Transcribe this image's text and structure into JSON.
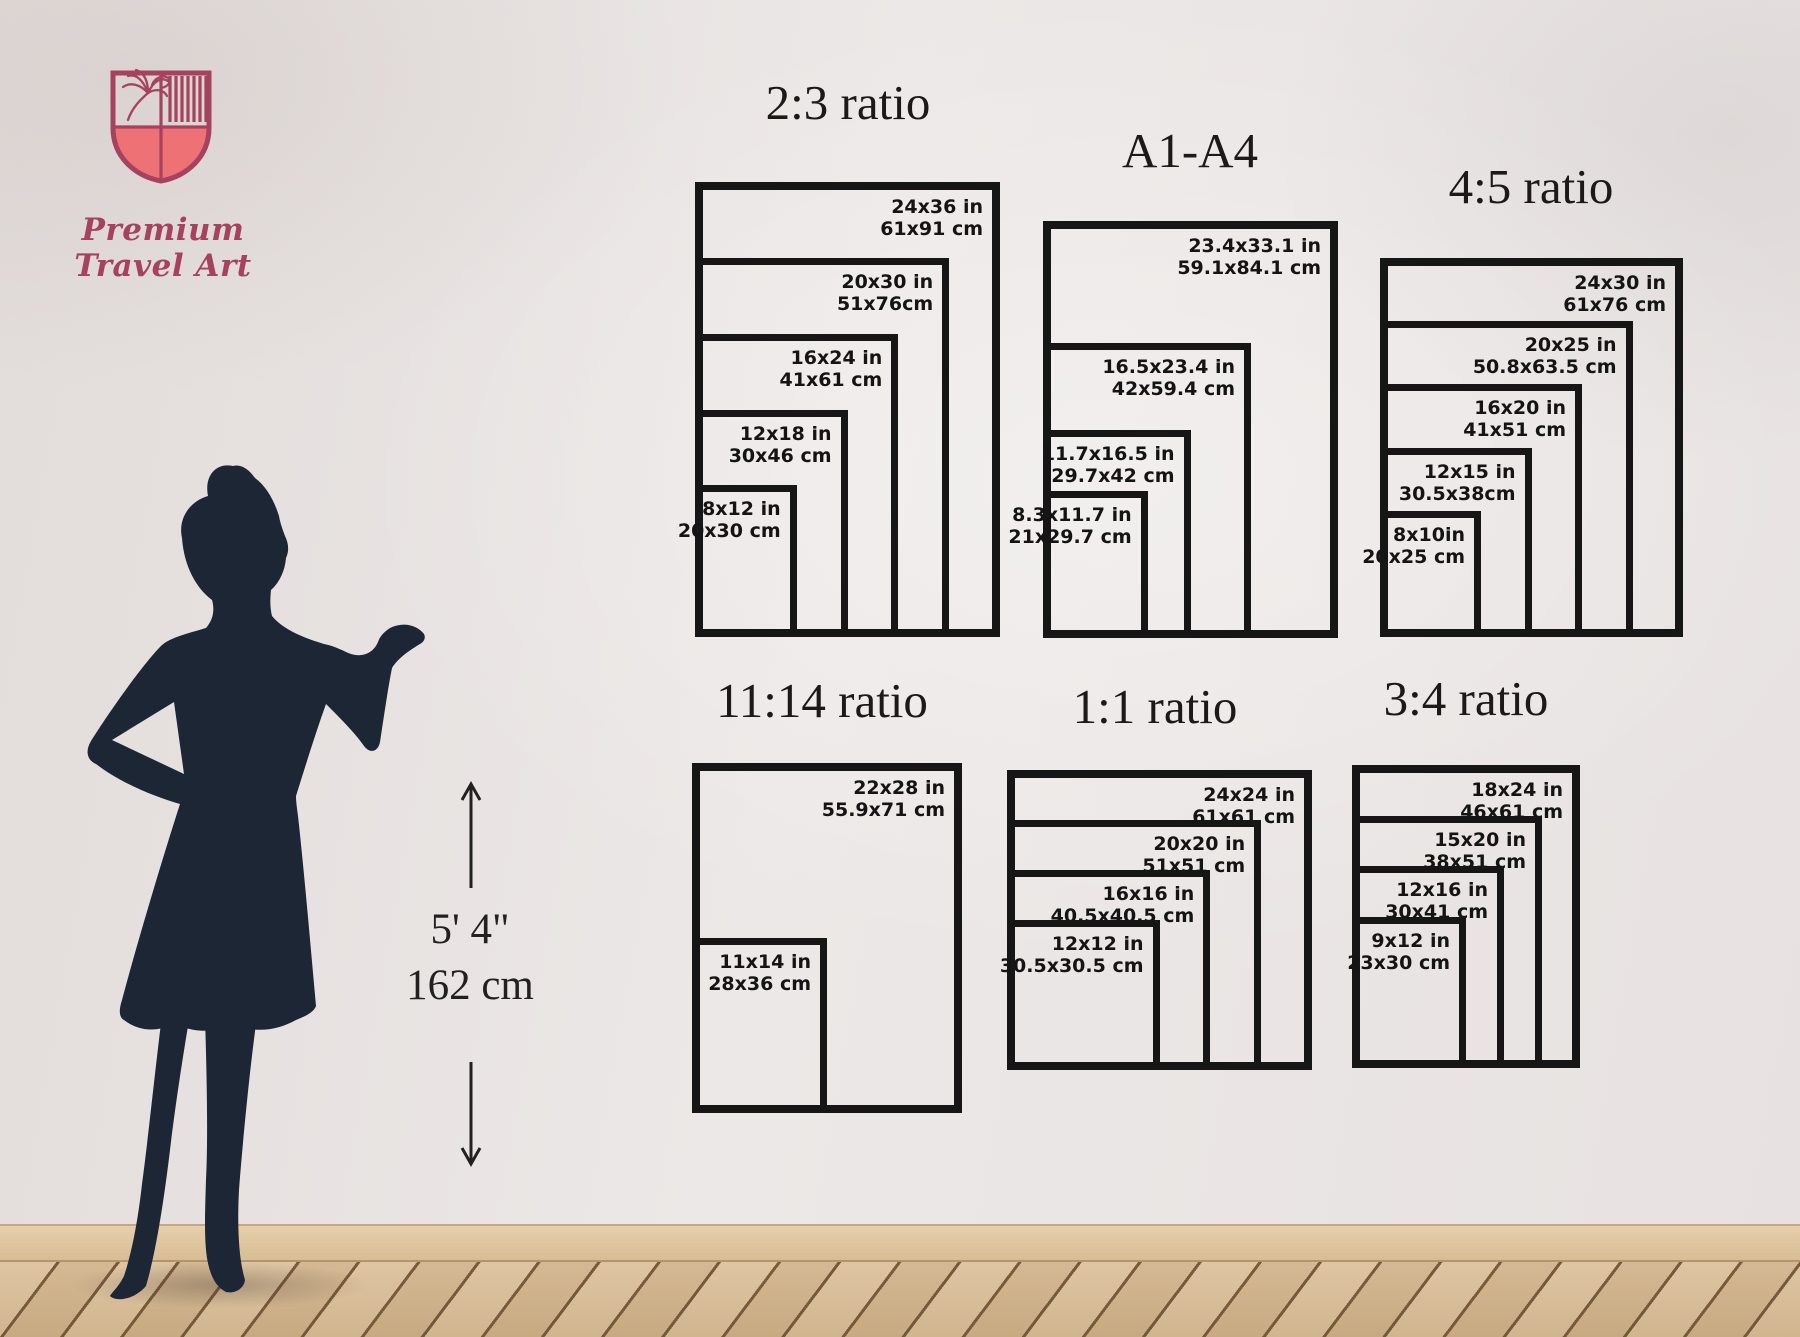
{
  "brand": {
    "name": "Premium Travel Art"
  },
  "height_indicator": {
    "imperial": "5' 4\"",
    "metric": "162 cm"
  },
  "colors": {
    "brand_maroon": "#a5425e",
    "brand_coral": "#ee7176",
    "frame_black": "#161616",
    "silhouette_navy": "#1d2634",
    "label_text": "#141414",
    "title_text": "#1c1917"
  },
  "groups": [
    {
      "id": "ratio-2-3",
      "title": "2:3 ratio",
      "sizes": [
        {
          "inches": "24x36 in",
          "cm": "61x91 cm"
        },
        {
          "inches": "20x30 in",
          "cm": "51x76cm"
        },
        {
          "inches": "16x24 in",
          "cm": "41x61 cm"
        },
        {
          "inches": "12x18 in",
          "cm": "30x46 cm"
        },
        {
          "inches": "8x12 in",
          "cm": "20x30 cm"
        }
      ]
    },
    {
      "id": "ratio-a1-a4",
      "title": "A1-A4",
      "sizes": [
        {
          "inches": "23.4x33.1 in",
          "cm": "59.1x84.1 cm"
        },
        {
          "inches": "16.5x23.4 in",
          "cm": "42x59.4 cm"
        },
        {
          "inches": "11.7x16.5 in",
          "cm": "29.7x42 cm"
        },
        {
          "inches": "8.3x11.7 in",
          "cm": "21x29.7 cm"
        }
      ]
    },
    {
      "id": "ratio-4-5",
      "title": "4:5 ratio",
      "sizes": [
        {
          "inches": "24x30 in",
          "cm": "61x76 cm"
        },
        {
          "inches": "20x25 in",
          "cm": "50.8x63.5 cm"
        },
        {
          "inches": "16x20 in",
          "cm": "41x51 cm"
        },
        {
          "inches": "12x15 in",
          "cm": "30.5x38cm"
        },
        {
          "inches": "8x10in",
          "cm": "20x25 cm"
        }
      ]
    },
    {
      "id": "ratio-11-14",
      "title": "11:14 ratio",
      "sizes": [
        {
          "inches": "22x28 in",
          "cm": "55.9x71 cm"
        },
        {
          "inches": "11x14 in",
          "cm": "28x36 cm"
        }
      ]
    },
    {
      "id": "ratio-1-1",
      "title": "1:1 ratio",
      "sizes": [
        {
          "inches": "24x24 in",
          "cm": "61x61 cm"
        },
        {
          "inches": "20x20 in",
          "cm": "51x51 cm"
        },
        {
          "inches": "16x16 in",
          "cm": "40.5x40.5 cm"
        },
        {
          "inches": "12x12 in",
          "cm": "30.5x30.5 cm"
        }
      ]
    },
    {
      "id": "ratio-3-4",
      "title": "3:4 ratio",
      "sizes": [
        {
          "inches": "18x24 in",
          "cm": "46x61 cm"
        },
        {
          "inches": "15x20 in",
          "cm": "38x51 cm"
        },
        {
          "inches": "12x16 in",
          "cm": "30x41 cm"
        },
        {
          "inches": "9x12 in",
          "cm": "23x30 cm"
        }
      ]
    }
  ]
}
